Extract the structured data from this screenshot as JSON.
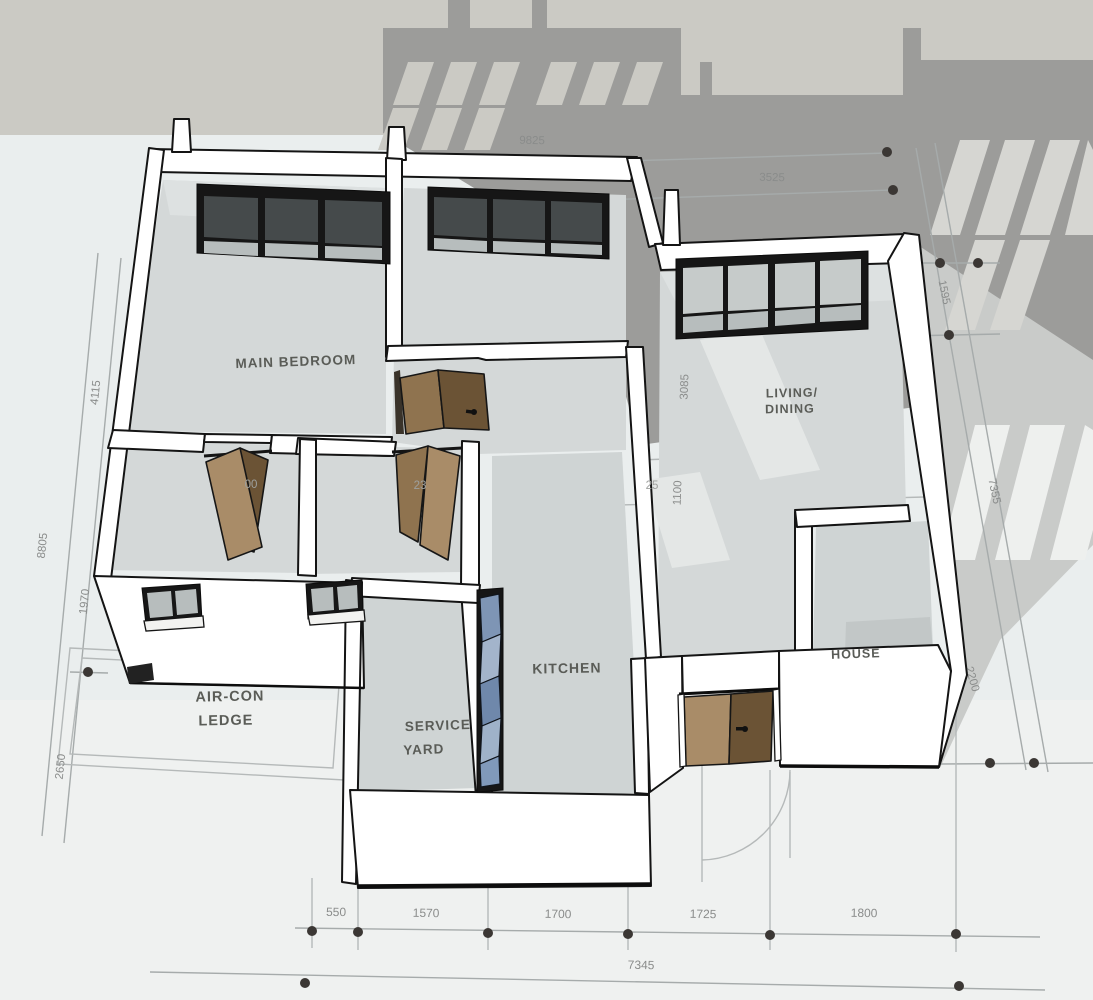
{
  "scene": {
    "width": 1093,
    "height": 1000
  },
  "colors": {
    "top_band": "#cbcac4",
    "paper": "#eaeeee",
    "cast_shadow": "#9c9c9a",
    "shadow_on_paper": "#c9cbc9",
    "wall_white": "#ffffff",
    "outline_black": "#141414",
    "floor_gray": "#d4d8d8",
    "window_frame": "#161616",
    "door_wood_light": "#a98c68",
    "door_wood_dark": "#6b5335",
    "louver_blue": "#7e95b5",
    "dimension_text": "#8a8c8b",
    "room_text": "#5a5c57"
  },
  "rooms": {
    "labels": [
      {
        "id": "main-bedroom",
        "text": "MAIN BEDROOM",
        "x": 296,
        "y": 366,
        "rot": -2,
        "size": 13.5,
        "color": "#5a5c57"
      },
      {
        "id": "living-dining-1",
        "text": "LIVING/",
        "x": 792,
        "y": 397,
        "rot": -1,
        "size": 12.5,
        "color": "#5a5c57"
      },
      {
        "id": "living-dining-2",
        "text": "DINING",
        "x": 790,
        "y": 413,
        "rot": -1,
        "size": 12.5,
        "color": "#5a5c57"
      },
      {
        "id": "kitchen",
        "text": "KITCHEN",
        "x": 567,
        "y": 673,
        "rot": -1,
        "size": 14,
        "color": "#5a5c57"
      },
      {
        "id": "service-yard-1",
        "text": "SERVICE",
        "x": 438,
        "y": 730,
        "rot": -2,
        "size": 13.5,
        "color": "#5a5c57"
      },
      {
        "id": "service-yard-2",
        "text": "YARD",
        "x": 424,
        "y": 754,
        "rot": -2,
        "size": 13.5,
        "color": "#5a5c57"
      },
      {
        "id": "aircon-ledge-1",
        "text": "AIR-CON",
        "x": 230,
        "y": 701,
        "rot": -1,
        "size": 14.5,
        "color": "#656762"
      },
      {
        "id": "aircon-ledge-2",
        "text": "LEDGE",
        "x": 226,
        "y": 725,
        "rot": -1,
        "size": 14.5,
        "color": "#656762"
      },
      {
        "id": "household-shelter-partial",
        "text": "HOUSE",
        "x": 856,
        "y": 658,
        "rot": -2,
        "size": 12.5,
        "color": "#515350"
      }
    ]
  },
  "dimensions": {
    "labels": [
      {
        "text": "9825",
        "x": 532,
        "y": 144,
        "rot": 1,
        "size": 11.5,
        "layer": "plan"
      },
      {
        "text": "3525",
        "x": 772,
        "y": 181,
        "rot": 1,
        "size": 11.5,
        "layer": "plan"
      },
      {
        "text": "550",
        "x": 336,
        "y": 916,
        "rot": 1,
        "size": 12,
        "layer": "plan"
      },
      {
        "text": "1570",
        "x": 426,
        "y": 917,
        "rot": 1,
        "size": 12,
        "layer": "plan"
      },
      {
        "text": "1700",
        "x": 558,
        "y": 918,
        "rot": 1,
        "size": 12,
        "layer": "plan"
      },
      {
        "text": "1725",
        "x": 703,
        "y": 918,
        "rot": 1,
        "size": 12,
        "layer": "plan"
      },
      {
        "text": "1800",
        "x": 864,
        "y": 917,
        "rot": 1,
        "size": 12,
        "layer": "plan"
      },
      {
        "text": "7345",
        "x": 641,
        "y": 969,
        "rot": 1,
        "size": 12,
        "layer": "plan"
      },
      {
        "text": "8805",
        "x": 46,
        "y": 546,
        "rot": -84,
        "size": 11.5,
        "layer": "plan"
      },
      {
        "text": "1970",
        "x": 88,
        "y": 602,
        "rot": -84,
        "size": 11.5,
        "layer": "plan"
      },
      {
        "text": "2650",
        "x": 64,
        "y": 767,
        "rot": -84,
        "size": 11.5,
        "layer": "plan"
      },
      {
        "text": "4115",
        "x": 99,
        "y": 393,
        "rot": -84,
        "size": 11.5,
        "layer": "plan"
      },
      {
        "text": "7355",
        "x": 991,
        "y": 492,
        "rot": 78,
        "size": 11.5,
        "layer": "plan"
      },
      {
        "text": "2200",
        "x": 969,
        "y": 680,
        "rot": 74,
        "size": 11.5,
        "layer": "plan"
      },
      {
        "text": "1595",
        "x": 941,
        "y": 293,
        "rot": 78,
        "size": 11,
        "layer": "plan"
      },
      {
        "text": "3085",
        "x": 688,
        "y": 387,
        "rot": -88,
        "size": 11.5,
        "layer": "over"
      },
      {
        "text": "1100",
        "x": 681,
        "y": 493,
        "rot": -88,
        "size": 11.5,
        "layer": "over"
      },
      {
        "text": "25",
        "x": 652,
        "y": 489,
        "rot": 0,
        "size": 11.5,
        "layer": "over"
      },
      {
        "text": "00",
        "x": 251,
        "y": 488,
        "rot": 0,
        "size": 11.5,
        "layer": "over"
      },
      {
        "text": "23",
        "x": 420,
        "y": 489,
        "rot": 0,
        "size": 11.5,
        "layer": "over"
      }
    ]
  }
}
